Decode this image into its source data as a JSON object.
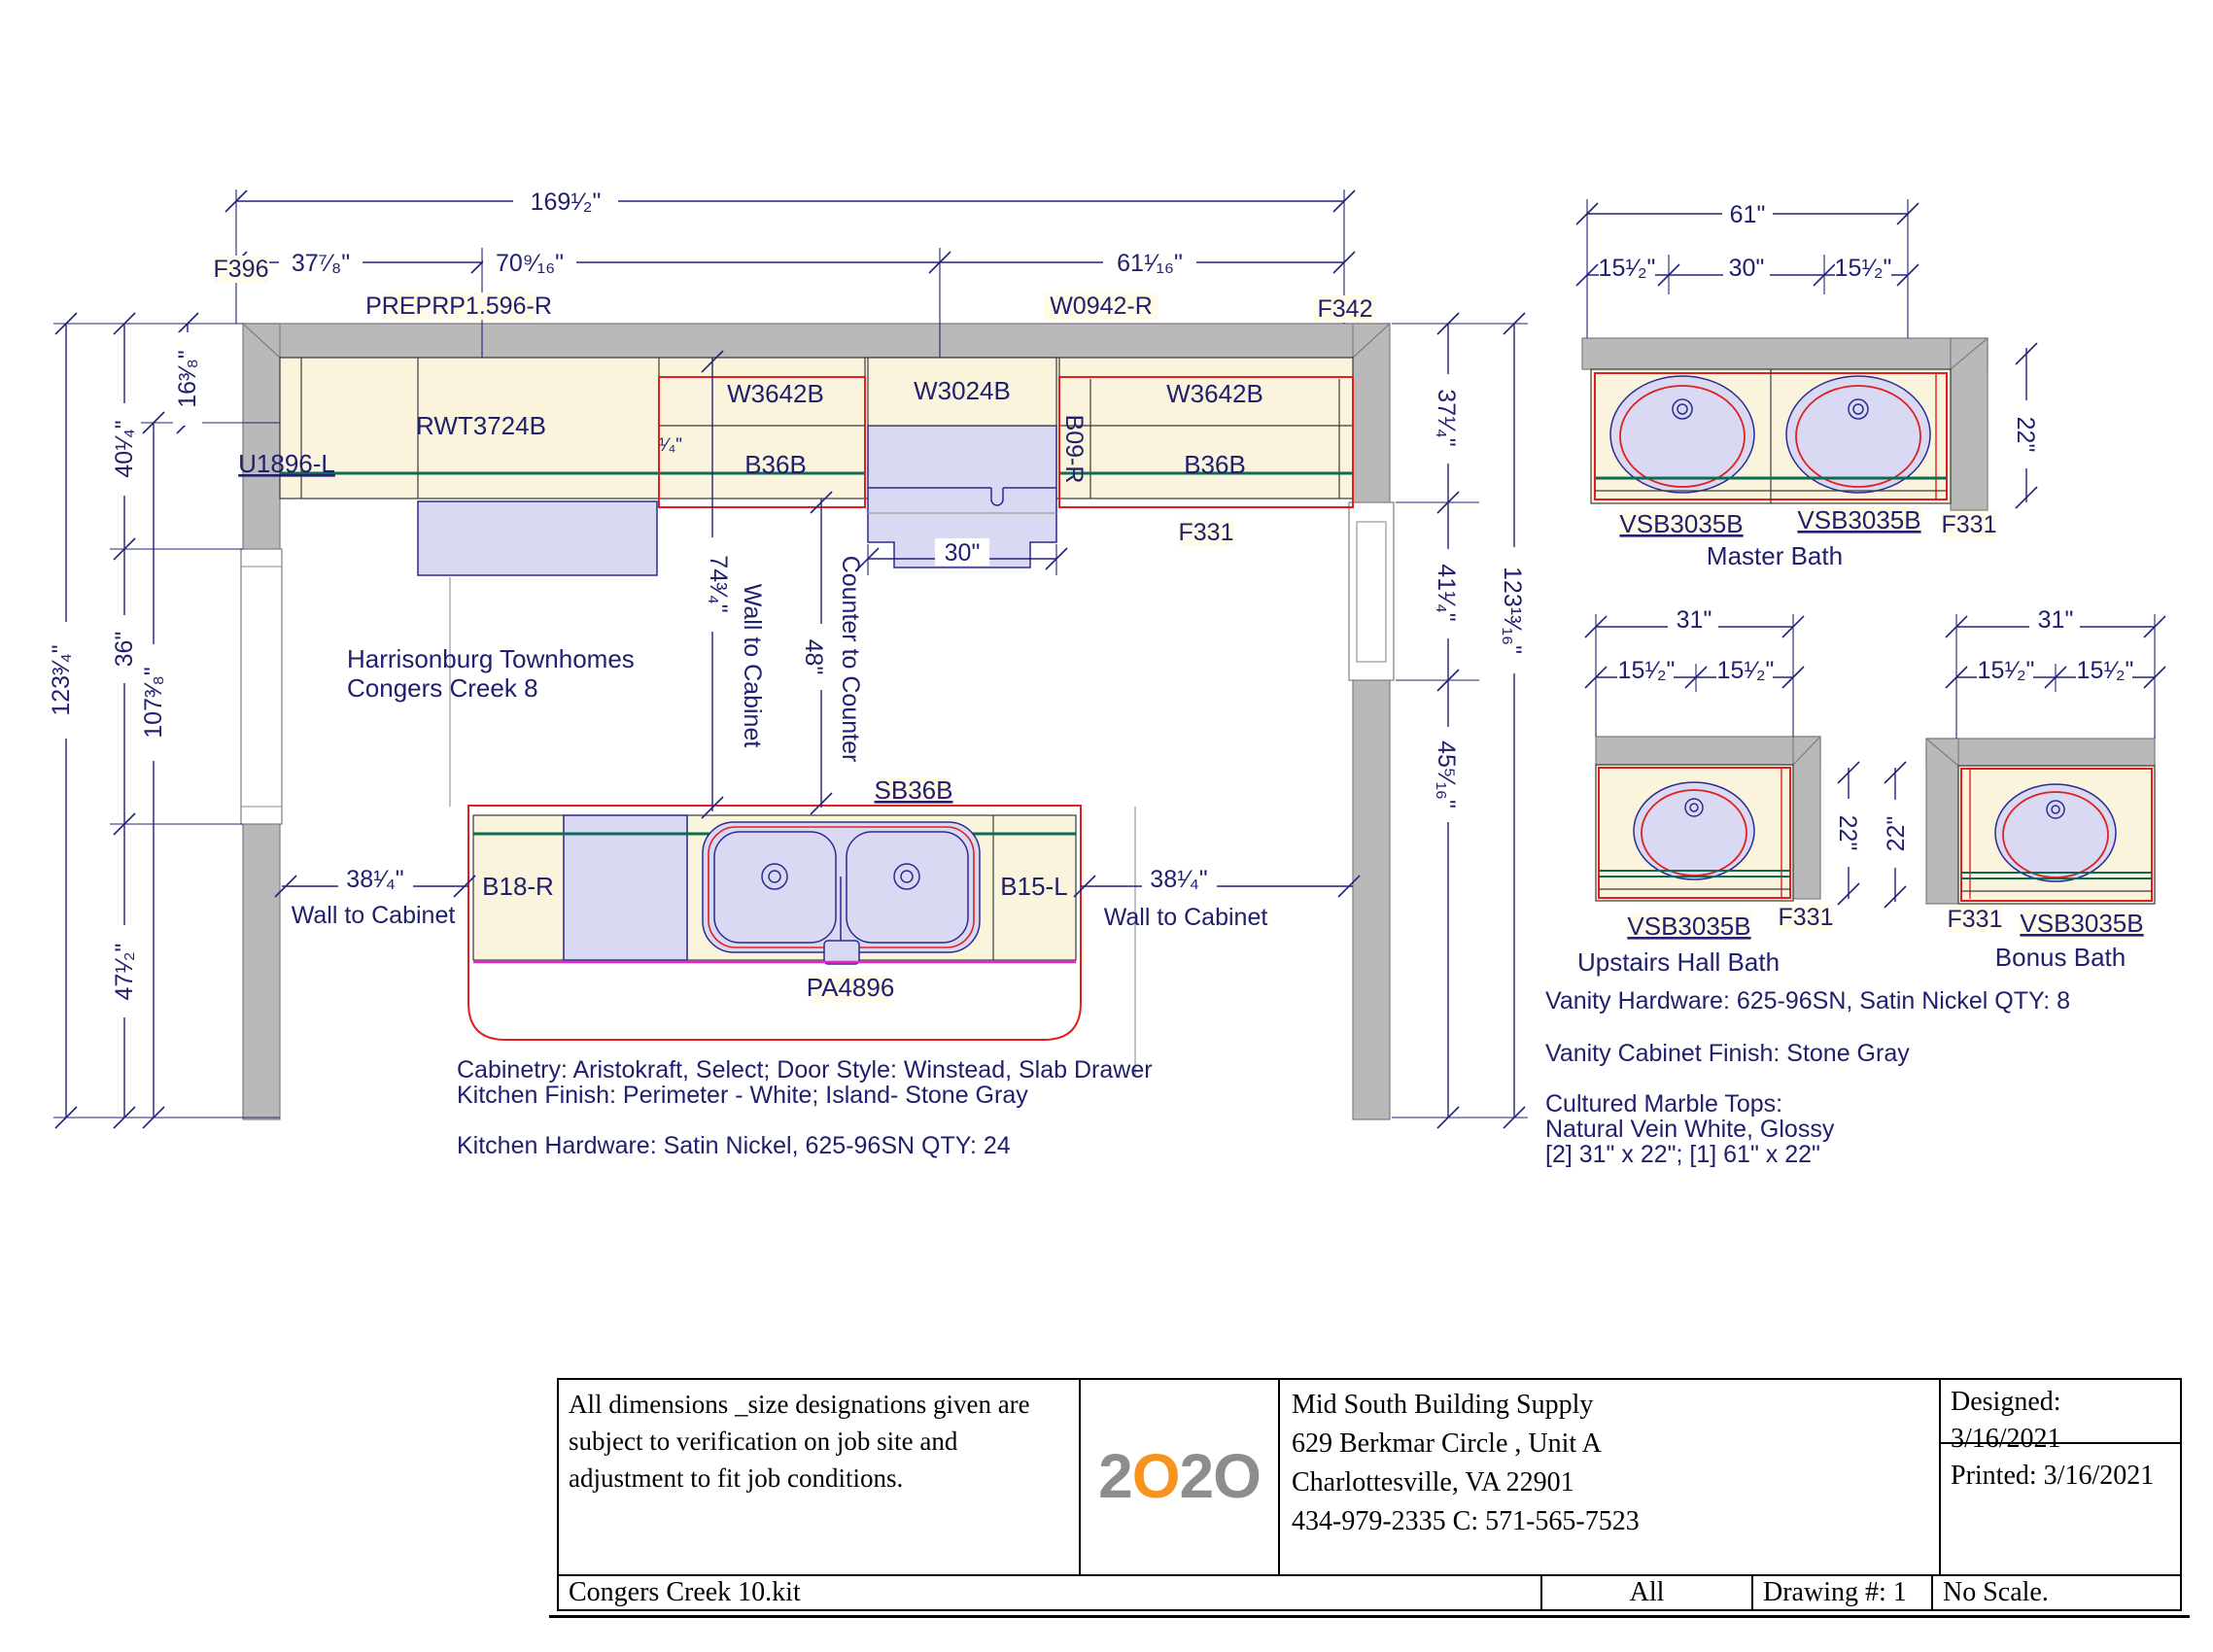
{
  "project": {
    "l1": "Harrisonburg Townhomes",
    "l2": "Congers Creek 8"
  },
  "k": {
    "d": {
      "ow": "169¹⁄₂\"",
      "s1": "37⁷⁄₈\"",
      "s2": "70⁹⁄₁₆\"",
      "s3": "61¹⁄₁₆\"",
      "lo": "123³⁄₄\"",
      "lt": "16³⁄₈\"",
      "lu": "40¹⁄₄\"",
      "lm": "36\"",
      "l7": "107³⁄₈\"",
      "lb": "47¹⁄₂\"",
      "ro": "123¹³⁄₁₆\"",
      "ru": "37¹⁄₄\"",
      "rm": "41¹⁄₄\"",
      "rl": "45⁵⁄₁₆\"",
      "wtc": "74³⁄₄\"",
      "wtct": "Wall to Cabinet",
      "ctc": "48\"",
      "ctct": "Counter to Counter",
      "r30": "30\"",
      "lc": "38¹⁄₄\"",
      "lct": "Wall to Cabinet",
      "rc": "38¹⁄₄\"",
      "rct": "Wall to Cabinet",
      "q": "¹⁄₄\""
    },
    "c": {
      "f396": "F396",
      "prep": "PREPRP1.596-R",
      "w0942": "W0942-R",
      "f342": "F342",
      "u1896": "U1896-L",
      "rwt": "RWT3724B",
      "w3642a": "W3642B",
      "b36a": "B36B",
      "w3024": "W3024B",
      "b09": "B09-R",
      "w3642b": "W3642B",
      "b36bb": "B36B",
      "f331": "F331",
      "b18": "B18-R",
      "sb36": "SB36B",
      "b15": "B15-L",
      "pa": "PA4896"
    },
    "n1": "Cabinetry: Aristokraft, Select;  Door Style: Winstead, Slab Drawer",
    "n2": "Kitchen Finish: Perimeter - White; Island- Stone Gray",
    "n3": "Kitchen Hardware: Satin Nickel, 625-96SN QTY: 24"
  },
  "bm": {
    "t": "Master Bath",
    "w": "61\"",
    "l": "15¹⁄₂\"",
    "c": "30\"",
    "r": "15¹⁄₂\"",
    "d": "22\"",
    "c1": "VSB3035B",
    "c2": "VSB3035B",
    "f": "F331"
  },
  "bh": {
    "t": "Upstairs Hall Bath",
    "w": "31\"",
    "l": "15¹⁄₂\"",
    "r": "15¹⁄₂\"",
    "d": "22\"",
    "c1": "VSB3035B",
    "f": "F331"
  },
  "bb": {
    "t": "Bonus Bath",
    "w": "31\"",
    "l": "15¹⁄₂\"",
    "r": "15¹⁄₂\"",
    "d": "22\"",
    "c1": "VSB3035B",
    "f": "F331"
  },
  "bn": {
    "n1": "Vanity Hardware: 625-96SN, Satin Nickel QTY: 8",
    "n2": "Vanity Cabinet Finish: Stone Gray",
    "n3": "Cultured Marble Tops:",
    "n4": "Natural Vein White, Glossy",
    "n5": "[2] 31\" x 22\"; [1] 61\" x 22\""
  },
  "tb": {
    "disc": "All dimensions _size designations given are subject to verification on job site and adjustment to fit job conditions.",
    "l1": "2",
    "l2": "O",
    "l3": "2",
    "l4": "O",
    "co1": "Mid South Building Supply",
    "co2": "629 Berkmar Circle , Unit A",
    "co3": "Charlottesville, VA 22901",
    "co4": "434-979-2335 C: 571-565-7523",
    "des": "Designed: 3/16/2021",
    "pr": "Printed: 3/16/2021",
    "file": "Congers Creek 10.kit",
    "sheet": "All",
    "dwg": "Drawing #: 1",
    "scale": "No Scale."
  },
  "colors": {
    "navy": "#20206e",
    "red": "#e02020",
    "green": "#0e6a52",
    "magenta": "#ee22cc",
    "wall_gray": "#b9b9b9",
    "cream": "#faf4dd",
    "lavender": "#d9d9f4",
    "label_bg": "#fffbe8",
    "logo_orange": "#f7941e",
    "logo_gray": "#8d8d8d"
  }
}
